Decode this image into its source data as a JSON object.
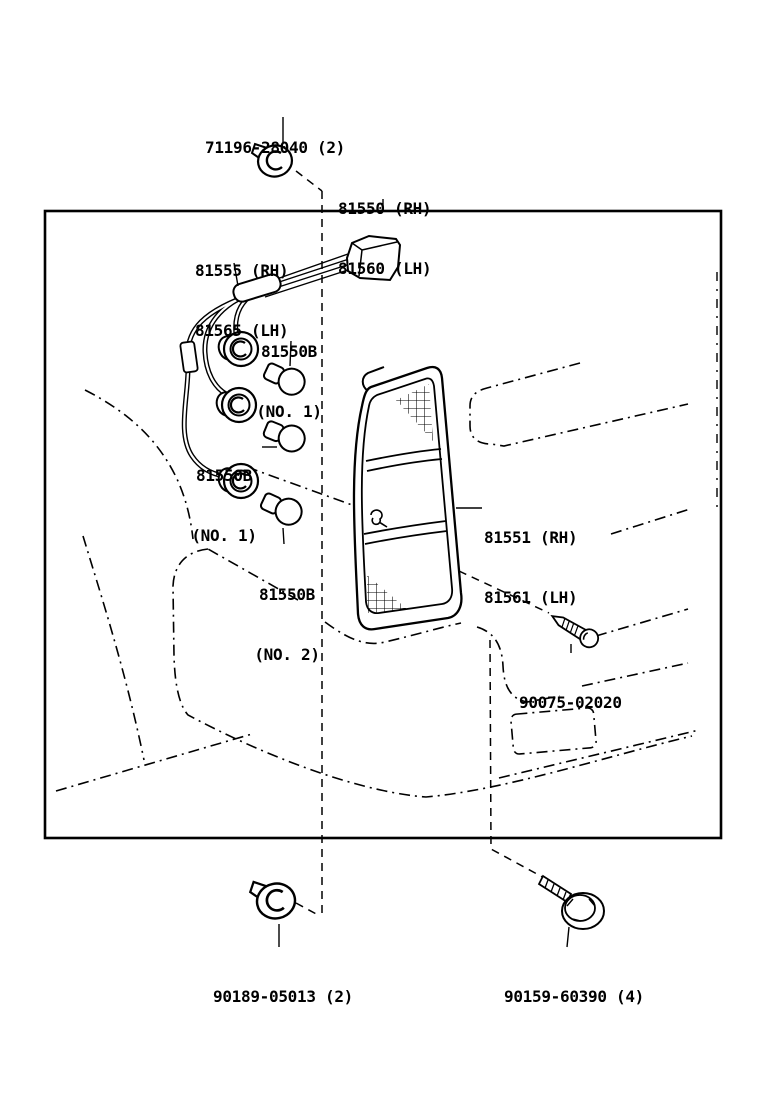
{
  "colors": {
    "ink": "#000000",
    "paper": "#ffffff"
  },
  "drawing_code": "810010-A",
  "parts": {
    "clip_top": "71196-28040 (2)",
    "lamp_assembly_line1": "81550 (RH)",
    "lamp_assembly_line2": "81560 (LH)",
    "socket_cord_line1": "81555 (RH)",
    "socket_cord_line2": "81565 (LH)",
    "bulb_no1_code": "81550B",
    "bulb_no1_note": "(NO. 1)",
    "bulb_no2_code": "81550B",
    "bulb_no2_note": "(NO. 2)",
    "lens_line1": "81551 (RH)",
    "lens_line2": "81561 (LH)",
    "screw_code": "90075-02020",
    "clip_bottom": "90189-05013 (2)",
    "bolt_code": "90159-60390 (4)"
  }
}
